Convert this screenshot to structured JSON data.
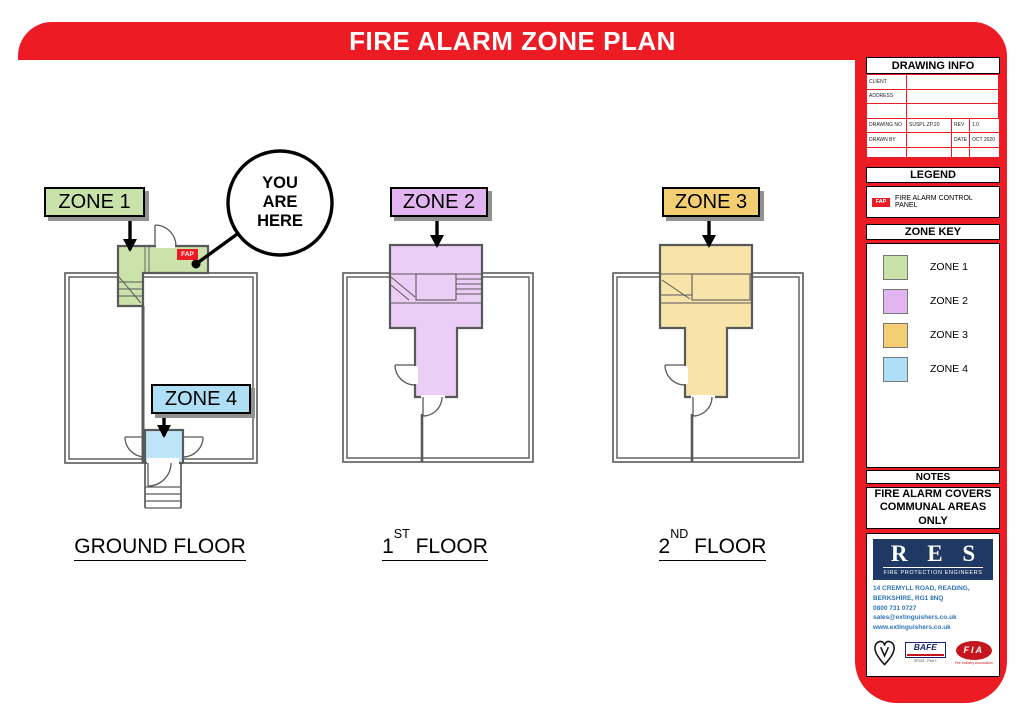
{
  "title": "FIRE ALARM ZONE PLAN",
  "you_are_here": [
    "YOU",
    "ARE",
    "HERE"
  ],
  "fap_badge": "FAP",
  "zones": [
    {
      "label": "ZONE 1",
      "color": "#C9E2A9"
    },
    {
      "label": "ZONE 2",
      "color": "#E3B5F0"
    },
    {
      "label": "ZONE 3",
      "color": "#F4CE73"
    },
    {
      "label": "ZONE 4",
      "color": "#AEDFF7"
    }
  ],
  "floors": [
    {
      "pre": "GROUND FLOOR",
      "sup": "",
      "post": ""
    },
    {
      "pre": "1",
      "sup": "ST",
      "post": " FLOOR"
    },
    {
      "pre": "2",
      "sup": "ND",
      "post": " FLOOR"
    }
  ],
  "sidebar": {
    "drawing_info": {
      "header": "DRAWING INFO",
      "client_label": "CLIENT",
      "client_value": "",
      "address_label": "ADDRESS",
      "address_value": "",
      "drawing_no_label": "DRAWING NO",
      "drawing_no_value": "SUSPL.ZP.20",
      "rev_label": "REV",
      "rev_value": "1.0",
      "drawn_by_label": "DRAWN BY",
      "drawn_by_value": "",
      "date_label": "DATE",
      "date_value": "OCT 2020"
    },
    "legend": {
      "header": "LEGEND",
      "fap": "FAP",
      "item": "FIRE ALARM CONTROL PANEL"
    },
    "zone_key": {
      "header": "ZONE KEY",
      "items": [
        {
          "label": "ZONE 1",
          "color": "#C9E2A9"
        },
        {
          "label": "ZONE 2",
          "color": "#E3B5F0"
        },
        {
          "label": "ZONE 3",
          "color": "#F4CE73"
        },
        {
          "label": "ZONE 4",
          "color": "#AEDFF7"
        }
      ]
    },
    "notes": {
      "header": "NOTES",
      "text": "FIRE ALARM COVERS COMMUNAL AREAS ONLY"
    },
    "company": {
      "name": "R E S",
      "tagline": "FIRE PROTECTION ENGINEERS",
      "address1": "14 CREMYLL ROAD, READING,",
      "address2": "BERKSHIRE, RG1 8NQ",
      "phone": "0800 731 0727",
      "email": "sales@extinguishers.co.uk",
      "web": "www.extinguishers.co.uk",
      "bafe": "BAFE",
      "bafe_sub": "SP203 - Part 1",
      "fia": "FIA",
      "fia_sub": "Fire Industry Association"
    }
  },
  "colors": {
    "accent_red": "#ED1C24",
    "navy": "#1F3864",
    "link_blue": "#2E74B5",
    "wall_gray": "#58595B"
  }
}
